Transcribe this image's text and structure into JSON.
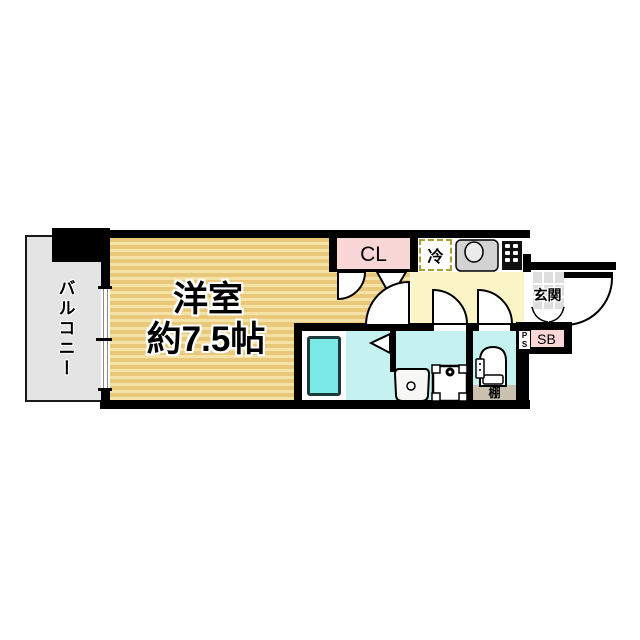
{
  "plan": {
    "type": "floor-plan",
    "labels": {
      "balcony": "バルコニー",
      "room_name": "洋室",
      "room_size": "約7.5帖",
      "closet": "CL",
      "refrigerator": "冷",
      "entrance": "玄関",
      "shoe_box": "SB",
      "pipe_space": "PS",
      "shelf": "棚"
    },
    "colors": {
      "wall": "#000000",
      "room_floor": "#e9c87c",
      "room_floor_stripe": "#f5e2a6",
      "balcony_floor": "#e4e4e4",
      "closet_fill": "#f9d7d6",
      "shoe_box_fill": "#f9d7d6",
      "kitchen_floor": "#faf4c6",
      "entrance_tile": "#dedede",
      "wet_area_floor": "#c6f1f1",
      "bathtub_fill": "#7ce9e9",
      "shelf_fill": "#c9c0ad",
      "fridge_dash": "#ad9d36"
    }
  }
}
